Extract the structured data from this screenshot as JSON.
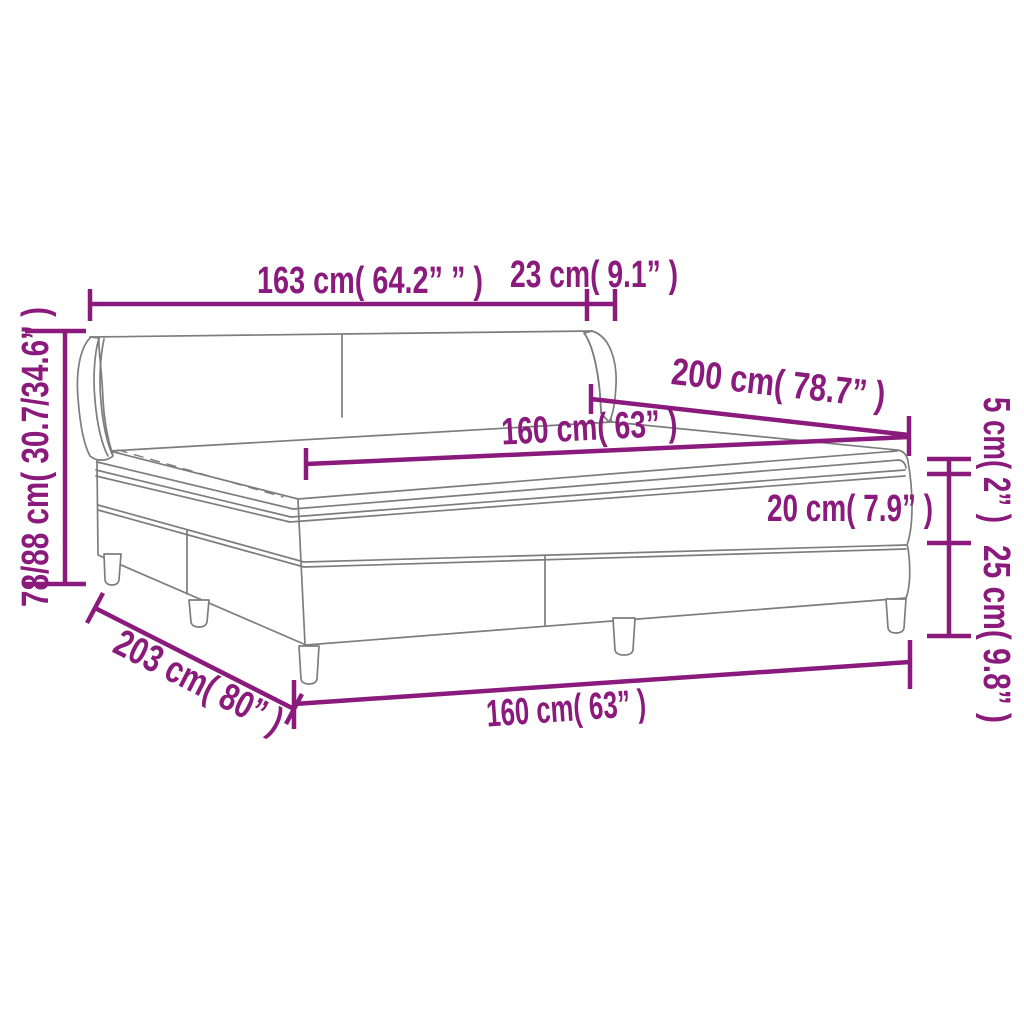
{
  "diagram_title": "box-spring-bed-dimension-diagram",
  "colors": {
    "dimension": "#8a1a7c",
    "outline": "#7d7d7d",
    "background": "#ffffff"
  },
  "labels": {
    "headboard_width": "163 cm( 64.2” ” )",
    "wing_depth": "23 cm( 9.1” )",
    "headboard_height": "78/88 cm( 30.7/34.6” )",
    "bed_length": "200 cm( 78.7” )",
    "mattress_width": "160 cm( 63” )",
    "mattress_thickness": "20 cm( 7.9” )",
    "topper_thickness": "5 cm( 2” )",
    "base_height": "25 cm( 9.8” )",
    "frame_length": "203 cm( 80” )",
    "frame_width": "160 cm( 63” )"
  }
}
